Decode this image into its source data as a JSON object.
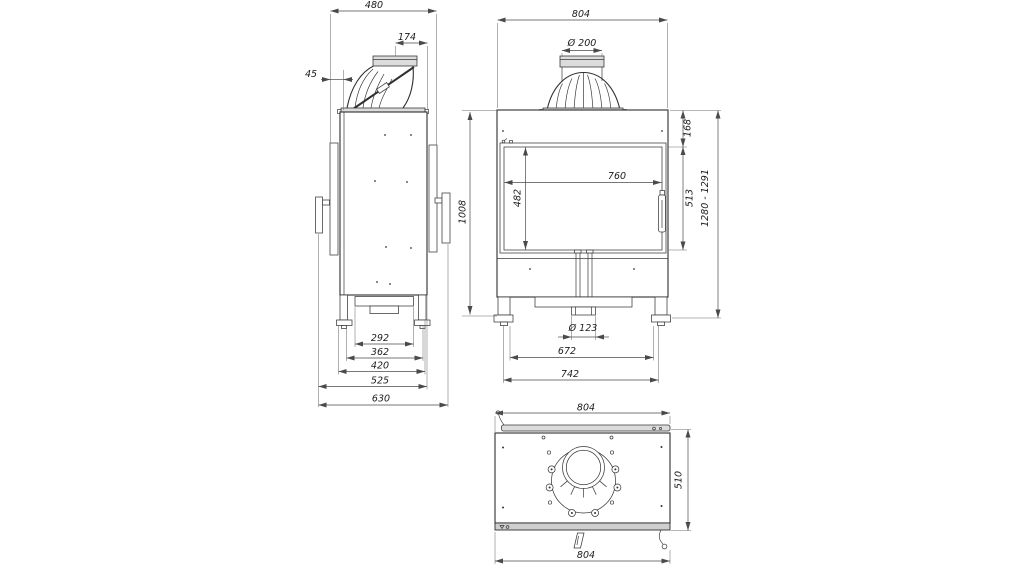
{
  "side_view": {
    "overall_width": "480",
    "flue_offset": "174",
    "front_clearance": "45",
    "base_widths": {
      "w1": "292",
      "w2": "362",
      "w3": "420",
      "w4": "525",
      "w5": "630"
    }
  },
  "front_view": {
    "overall_width": "804",
    "flue_diameter": "Ø 200",
    "body_height": "1008",
    "top_band_height": "168",
    "door_height": "513",
    "overall_height_range": "1280 - 1291",
    "glass_width": "760",
    "glass_height": "482",
    "air_inlet_diameter": "Ø 123",
    "leg_spacing_inner": "672",
    "leg_spacing_outer": "742"
  },
  "top_view": {
    "width_top": "804",
    "depth": "510",
    "width_bottom": "804"
  }
}
